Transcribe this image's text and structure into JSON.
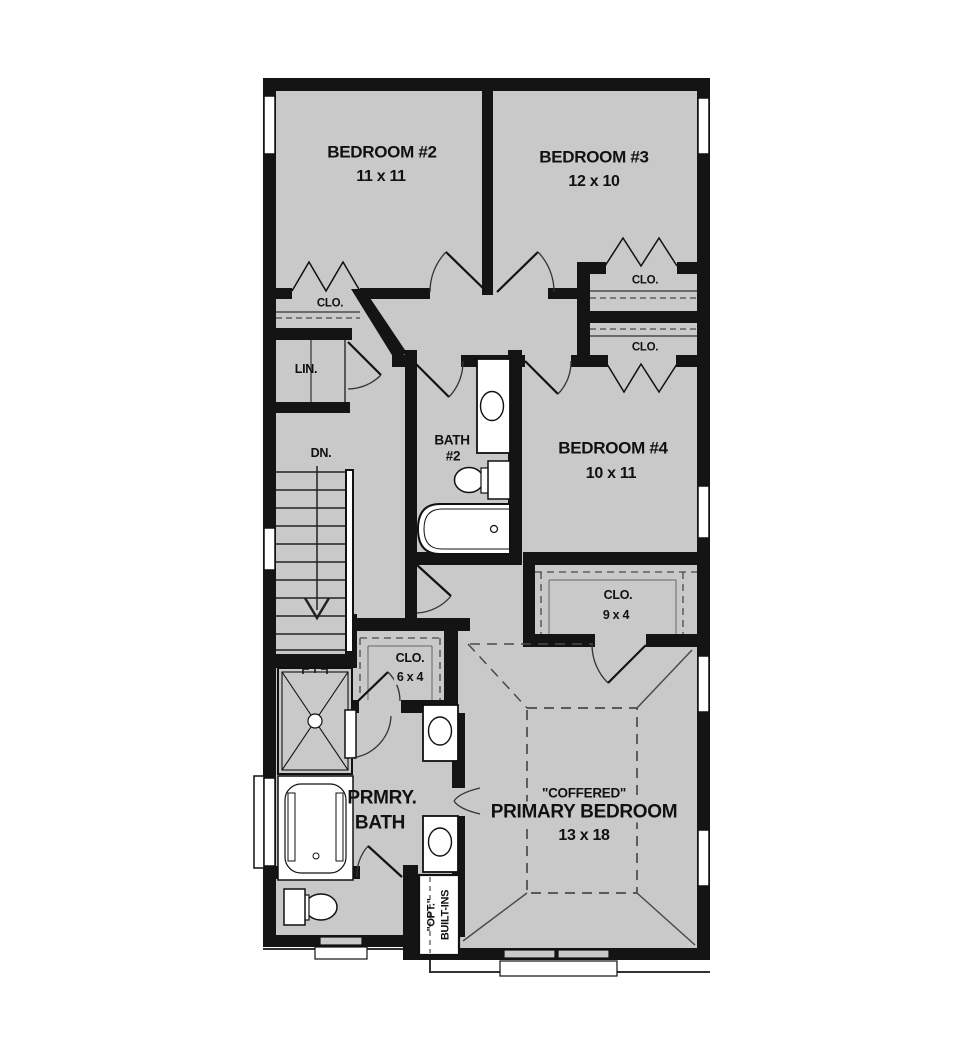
{
  "palette": {
    "floor": "#c9c9c9",
    "wall": "#141414",
    "fixture": "#ffffff",
    "line": "#222222",
    "dash": "#4a4a4a"
  },
  "plan": {
    "rooms": [
      {
        "id": "bedroom2",
        "name": "BEDROOM #2",
        "dims": "11 x 11"
      },
      {
        "id": "bedroom3",
        "name": "BEDROOM #3",
        "dims": "12 x 10"
      },
      {
        "id": "bedroom4",
        "name": "BEDROOM #4",
        "dims": "10 x 11"
      },
      {
        "id": "bath2",
        "name": "BATH",
        "number": "#2"
      },
      {
        "id": "primary_bath",
        "name": "PRMRY.",
        "name2": "BATH"
      },
      {
        "id": "primary_bedroom",
        "ceiling": "\"COFFERED\"",
        "name": "PRIMARY BEDROOM",
        "dims": "13 x 18"
      }
    ],
    "closets": {
      "bedroom2_clo": "CLO.",
      "bedroom3_clo": "CLO.",
      "bedroom4_clo": "CLO.",
      "linen": "LIN.",
      "walkin": {
        "label": "CLO.",
        "dims": "9 x 4"
      },
      "hall": {
        "label": "CLO.",
        "dims": "6 x 4"
      }
    },
    "stairs": {
      "label": "DN."
    },
    "builtins": {
      "line1": "\"OPT.\"",
      "line2": "BUILT-INS"
    }
  }
}
